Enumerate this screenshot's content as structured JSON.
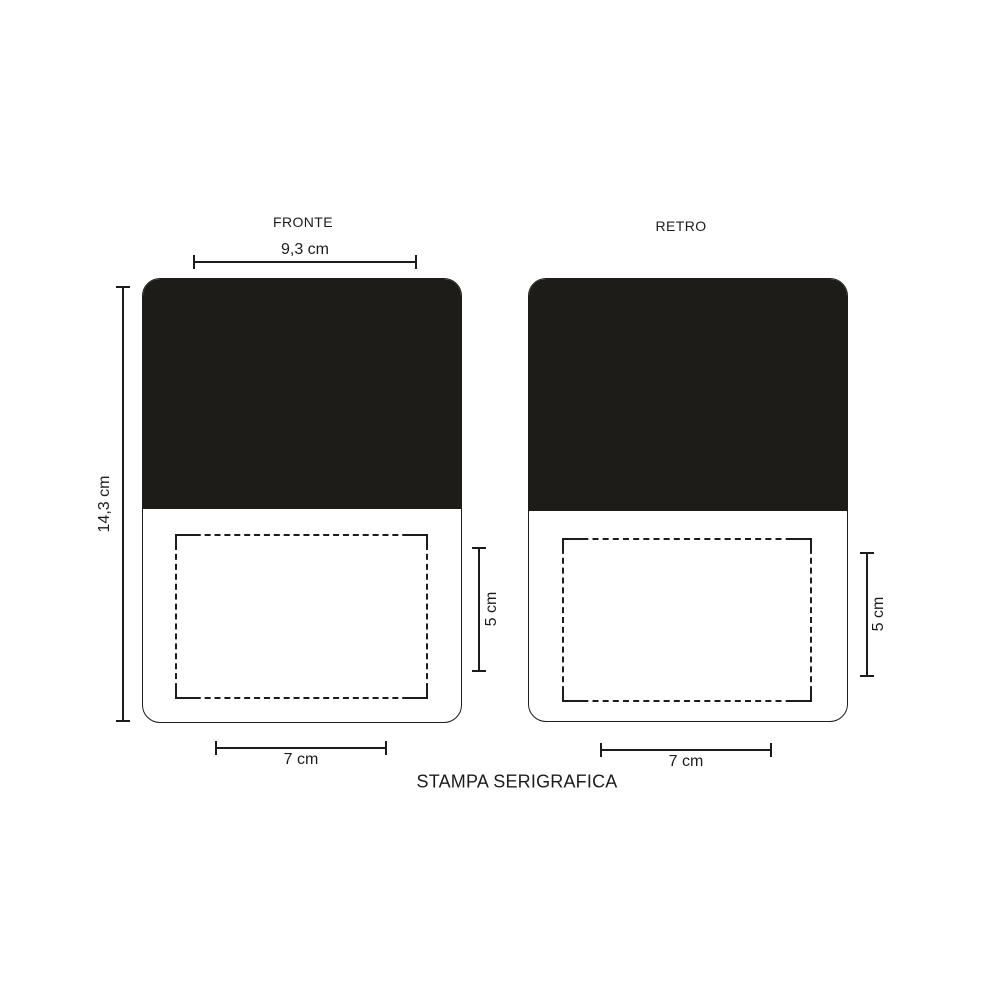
{
  "colors": {
    "ink": "#1d1c18",
    "background": "#ffffff"
  },
  "views": {
    "front": {
      "title": "FRONTE",
      "overall_width": "9,3 cm",
      "overall_height": "14,3 cm",
      "print_area_height": "5 cm",
      "print_area_width": "7 cm"
    },
    "back": {
      "title": "RETRO",
      "print_area_height": "5 cm",
      "print_area_width": "7 cm"
    }
  },
  "footer": {
    "technique_label": "STAMPA SERIGRAFICA"
  }
}
